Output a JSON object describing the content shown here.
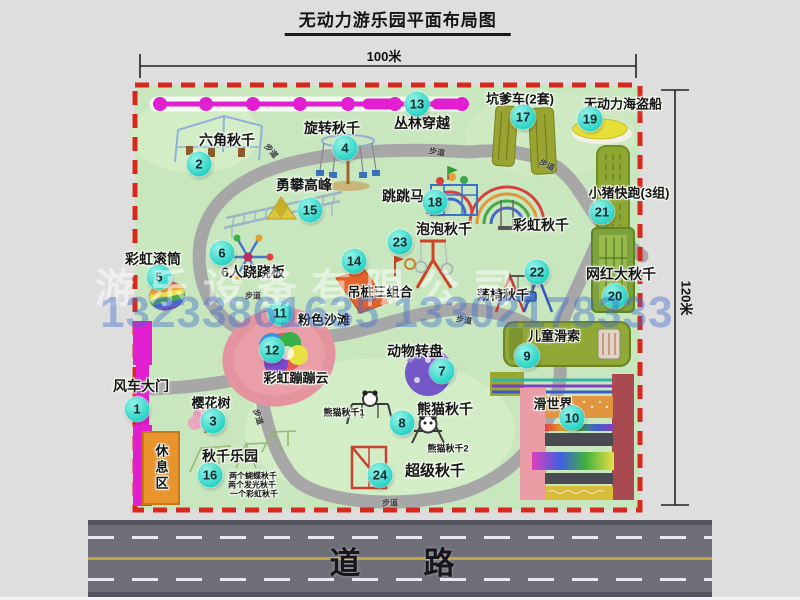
{
  "title": "无动力游乐园平面布局图",
  "dimensions": {
    "top": "100米",
    "right": "120米"
  },
  "road": {
    "label": "道　路"
  },
  "watermark": {
    "company": "游乐设备有限公司",
    "phone": "13233861635 13302178333"
  },
  "colors": {
    "map_green": "#c9e7bf",
    "border_red": "#d8281e",
    "badge_teal": "#29d3c5",
    "zipline_magenta": "#e11fd0",
    "road_gray": "#6e6e78"
  },
  "map": {
    "walkway_label": "步道",
    "facilities": [
      {
        "num": 1,
        "label": "风车大门",
        "size": 14,
        "badge": [
          137,
          409
        ],
        "label_pos": [
          141,
          386
        ]
      },
      {
        "num": 2,
        "label": "六角秋千",
        "size": 14,
        "badge": [
          199,
          164
        ],
        "label_pos": [
          227,
          140
        ]
      },
      {
        "num": 3,
        "label": "樱花树",
        "size": 13,
        "badge": [
          213,
          421
        ],
        "label_pos": [
          211,
          402
        ]
      },
      {
        "num": 4,
        "label": "旋转秋千",
        "size": 14,
        "badge": [
          345,
          148
        ],
        "label_pos": [
          332,
          128
        ]
      },
      {
        "num": 5,
        "label": "彩虹滚筒",
        "size": 14,
        "badge": [
          159,
          277
        ],
        "label_pos": [
          153,
          259
        ]
      },
      {
        "num": 6,
        "label": "6人跷跷板",
        "size": 14,
        "badge": [
          222,
          253
        ],
        "label_pos": [
          253,
          272
        ]
      },
      {
        "num": 7,
        "label": "动物转盘",
        "size": 14,
        "badge": [
          442,
          371
        ],
        "label_pos": [
          415,
          351
        ]
      },
      {
        "num": 8,
        "label": "熊猫秋千",
        "size": 14,
        "badge": [
          402,
          423
        ],
        "label_pos": [
          445,
          409
        ]
      },
      {
        "num": 9,
        "label": "儿童滑索",
        "size": 13,
        "badge": [
          527,
          356
        ],
        "label_pos": [
          554,
          335
        ]
      },
      {
        "num": 10,
        "label": "滑世界",
        "size": 13,
        "badge": [
          572,
          418
        ],
        "label_pos": [
          553,
          403
        ]
      },
      {
        "num": 11,
        "label": "粉色沙滩",
        "size": 13,
        "badge": [
          280,
          313
        ],
        "label_pos": [
          324,
          319
        ]
      },
      {
        "num": 12,
        "label": "彩虹蹦蹦云",
        "size": 13,
        "badge": [
          272,
          350
        ],
        "label_pos": [
          296,
          377
        ]
      },
      {
        "num": 13,
        "label": "丛林穿越",
        "size": 14,
        "badge": [
          417,
          104
        ],
        "label_pos": [
          422,
          123
        ]
      },
      {
        "num": 14,
        "label": "吊桩三组合",
        "size": 13,
        "badge": [
          354,
          261
        ],
        "label_pos": [
          380,
          291
        ]
      },
      {
        "num": 15,
        "label": "勇攀高峰",
        "size": 14,
        "badge": [
          310,
          210
        ],
        "label_pos": [
          304,
          185
        ]
      },
      {
        "num": 16,
        "label": "秋千乐园",
        "size": 14,
        "badge": [
          210,
          475
        ],
        "label_pos": [
          230,
          456
        ]
      },
      {
        "num": 17,
        "label": "坑爹车(2套)",
        "size": 13,
        "badge": [
          523,
          117
        ],
        "label_pos": [
          520,
          98
        ]
      },
      {
        "num": 18,
        "label": "跳跳马",
        "size": 14,
        "badge": [
          435,
          202
        ],
        "label_pos": [
          403,
          196
        ]
      },
      {
        "num": 19,
        "label": "无动力海盗船",
        "size": 13,
        "badge": [
          590,
          119
        ],
        "label_pos": [
          623,
          103
        ]
      },
      {
        "num": 20,
        "label": "网红大秋千",
        "size": 14,
        "badge": [
          615,
          296
        ],
        "label_pos": [
          621,
          274
        ]
      },
      {
        "num": 21,
        "label": "小猪快跑(3组)",
        "size": 13,
        "badge": [
          602,
          212
        ],
        "label_pos": [
          629,
          192
        ]
      },
      {
        "num": 22,
        "label": "荡椅秋千",
        "size": 13,
        "badge": [
          537,
          272
        ],
        "label_pos": [
          503,
          294
        ]
      },
      {
        "num": 23,
        "label": "泡泡秋千",
        "size": 14,
        "badge": [
          400,
          242
        ],
        "label_pos": [
          444,
          229
        ]
      },
      {
        "num": 24,
        "label": "超级秋千",
        "size": 15,
        "badge": [
          380,
          475
        ],
        "label_pos": [
          435,
          470
        ]
      }
    ],
    "sublabels": [
      {
        "text": "彩虹秋千",
        "pos": [
          541,
          225
        ],
        "size": 14,
        "vertical": false
      },
      {
        "text": "熊猫秋千1",
        "pos": [
          344,
          412
        ],
        "size": 9,
        "vertical": false
      },
      {
        "text": "熊猫秋千2",
        "pos": [
          448,
          448
        ],
        "size": 9,
        "vertical": false
      },
      {
        "text": "两个蝴蝶秋千",
        "pos": [
          253,
          476
        ],
        "size": 8,
        "vertical": false
      },
      {
        "text": "两个发光秋千",
        "pos": [
          252,
          485
        ],
        "size": 8,
        "vertical": false
      },
      {
        "text": "一个彩虹秋千",
        "pos": [
          254,
          494
        ],
        "size": 8,
        "vertical": false
      },
      {
        "text": "休息区",
        "pos": [
          161,
          468
        ],
        "size": 13,
        "vertical": true
      }
    ],
    "walkways": [
      {
        "pos": [
          271,
          151
        ],
        "rot": 50
      },
      {
        "pos": [
          437,
          152
        ],
        "rot": 10
      },
      {
        "pos": [
          547,
          165
        ],
        "rot": 28
      },
      {
        "pos": [
          253,
          296
        ],
        "rot": 0
      },
      {
        "pos": [
          464,
          320
        ],
        "rot": 10
      },
      {
        "pos": [
          258,
          417
        ],
        "rot": 72
      },
      {
        "pos": [
          390,
          503
        ],
        "rot": 0
      }
    ]
  }
}
